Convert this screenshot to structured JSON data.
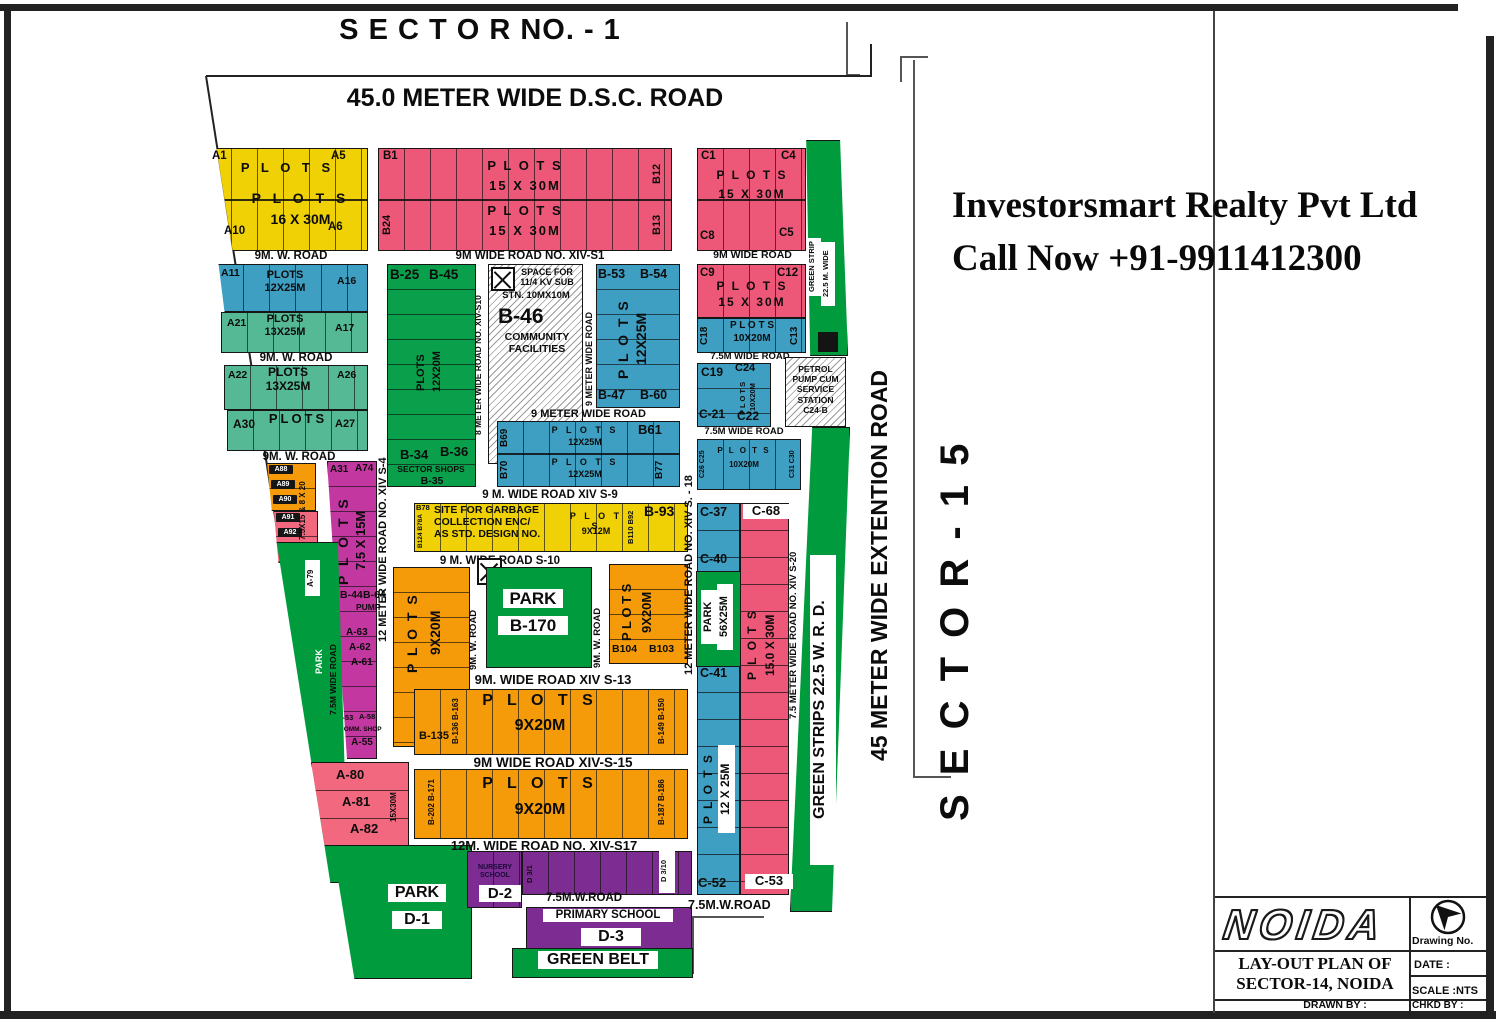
{
  "colors": {
    "yellow": "#EFD106",
    "pink": "#EE5878",
    "pink_light": "#F2697F",
    "blue": "#3E9FC2",
    "teal": "#55B996",
    "green": "#009B3C",
    "green_dark": "#0AA04B",
    "orange": "#F59B0A",
    "magenta": "#C337A0",
    "purple": "#7D2D91",
    "black": "#141414",
    "white": "#FFFFFF"
  },
  "header": {
    "sector_no": "S E C T O R NO. - 1",
    "dsc_road": "45.0 METER WIDE D.S.C. ROAD"
  },
  "promo": {
    "line1": "Investorsmart Realty Pvt Ltd",
    "line2": "Call Now +91-9911412300"
  },
  "margin": {
    "extension_road": "45 METER WIDE EXTENTION ROAD",
    "sector_15": "S E C T O R - 1 5"
  },
  "a": {
    "a1": "A1",
    "a5": "A5",
    "plots_top": "P L O T S",
    "plots16_1": "P L O T S",
    "plots16_2": "16 X 30M",
    "a10": "A10",
    "a6": "A6",
    "road_9mw1": "9M. W. ROAD",
    "a11": "A11",
    "plots12x25": "PLOTS\n12X25M",
    "a16": "A16",
    "a21": "A21",
    "plots13x25": "PLOTS\n13X25M",
    "a17": "A17",
    "road_9mw2": "9M. W. ROAD",
    "a22": "A22",
    "plots13x25b": "PLOTS\n13X25M",
    "a26": "A26",
    "a30": "A30",
    "plots_sm": "PLOTS",
    "a27": "A27",
    "road_9mw3": "9M. W. ROAD",
    "a88": "A88",
    "a89": "A89",
    "a90": "A90",
    "a91": "A91",
    "a92": "A92",
    "a93": "A93",
    "size_mix": "7.5X15 & 8 X 20",
    "a31": "A31",
    "a74": "A74",
    "plots_v": "P L O T S",
    "size75x15": "7.5 X 15M",
    "b44": "B-44",
    "b64": "B-64",
    "pump": "PUMP",
    "a63": "A-63",
    "a62": "A-62",
    "a61": "A-61",
    "a53": "A-53",
    "a58": "A-58",
    "comm_shop": "COMM. SHOP",
    "a55": "A-55",
    "a79": "A-79",
    "park": "PARK",
    "road75v": "7.5M WIDE ROAD",
    "a80": "A-80",
    "a81": "A-81",
    "a82": "A-82",
    "size15x30": "15X30M"
  },
  "b": {
    "b1": "B1",
    "b12": "B12",
    "plots15_1": "P L O T S\n15 X 30M",
    "b24": "B24",
    "b13": "B13",
    "plots15_2": "P L O T S\n15 X 30M",
    "road_s1": "9M WIDE ROAD NO. XIV-S1",
    "b25": "B-25",
    "b45": "B-45",
    "plots_v": "PLOTS",
    "size12x20": "12X20M",
    "b34": "B-34",
    "b36": "B-36",
    "sector_shops": "SECTOR SHOPS",
    "b35": "B-35",
    "road_s10v": "8 METER WIDE ROAD NO. XIV-S10",
    "kv1": "SPACE FOR\n11/4 KV SUB",
    "kv2": "STN. 10MX10M",
    "b46": "B-46",
    "community": "COMMUNITY\nFACILITIES",
    "road_9mv": "9 METER WIDE ROAD",
    "b53": "B-53",
    "b54": "B-54",
    "plots_v2": "P L O T S",
    "size12x25": "12X25M",
    "b47": "B-47",
    "b60": "B-60",
    "road_9mh": "9 METER WIDE ROAD",
    "b69": "B69",
    "plots_r1": "P L O T S",
    "size_r1": "12X25M",
    "b61": "B61",
    "b70": "B70",
    "plots_r2": "P L O T S",
    "size_r2": "12X25M",
    "b77": "B77",
    "road_s9": "9 M. WIDE ROAD XIV S-9",
    "b78": "B78",
    "b124": "B124 B78A",
    "garbage": "SITE FOR GARBAGE\nCOLLECTION ENC/\nAS STD. DESIGN NO.",
    "plots9x12": "P L O T S",
    "size9x12": "9X12M",
    "b110": "B110 B92",
    "b93": "B-93",
    "road_s10h": "9 M. WIDE ROAD S-10",
    "plots_lv": "P L O T S",
    "size_lv": "9X20M",
    "road_9wv1": "9M. W. ROAD",
    "park": "PARK",
    "b170": "B-170",
    "road_9wv2": "9M. W. ROAD",
    "plots_rv": "P L O T S",
    "size_rv": "9X20M",
    "b104": "B104",
    "b103": "B103",
    "road_s13": "9M. WIDE ROAD XIV S-13",
    "plots1": "P L O T S",
    "size1": "9X20M",
    "b135": "B-135",
    "b136": "B-136 B-163",
    "b149": "B-149 B-150",
    "road_s15": "9M WIDE ROAD XIV-S-15",
    "plots2": "P L O T S",
    "size2": "9X20M",
    "b202": "B-202 B-171",
    "b187": "B-187 B-186",
    "road_s17": "12M. WIDE ROAD NO. XIV-S17",
    "road_s4": "12 METER WIDE ROAD NO. XIV S-4",
    "road_s18": "12 METER WIDE ROAD NO. XIV S. - 18"
  },
  "c": {
    "c1": "C1",
    "c4": "C4",
    "plots15a": "P L O T S\n15 X 30M",
    "c8": "C8",
    "c5": "C5",
    "road9m": "9M WIDE ROAD",
    "c9": "C9",
    "c12": "C12",
    "plots15b": "P L O T S\n15 X 30M",
    "c18": "C18",
    "plots10a": "P L O T S\n10X20M",
    "c13": "C13",
    "road75a": "7.5M WIDE ROAD",
    "c19": "C19",
    "c24": "C24",
    "plots10v": "P L O T S",
    "size10v": "10X20M",
    "c21": "C-21",
    "c22": "C22",
    "petrol": "PETROL\nPUMP CUM\nSERVICE\nSTATION\nC24-B",
    "road75b": "7.5M WIDE ROAD",
    "c26": "C26 C25",
    "plots10b": "P L O T S",
    "size10b": "10X20M",
    "c31": "C31 C30",
    "strip": "STRIP",
    "gs1": "GREEN STRIP",
    "gs2": "22.5 M. WIDE",
    "c37": "C-37",
    "c40": "C-40",
    "cpark": "PARK",
    "cpark_size": "56X25M",
    "c41": "C-41",
    "plots12v": "P L O T S",
    "size12v": "12 X 25M",
    "c52": "C-52",
    "c68": "C-68",
    "plots15v": "P L O T S",
    "size15v": "15.0 X 30M",
    "c53": "C-53",
    "road_s20": "7.5 METER WIDE ROAD NO. XIV S-20",
    "green_wrd": "GREEN STRIPS 22.5 W. R. D.",
    "road75w": "7.5M.W.ROAD"
  },
  "d": {
    "nursery": "NURSERY\nSCHOOL",
    "d2": "D-2",
    "d31": "D 3/1",
    "d310": "D 3/10",
    "road75w": "7.5M.W.ROAD",
    "primary": "PRIMARY SCHOOL",
    "d3": "D-3",
    "green_belt": "GREEN BELT",
    "park": "PARK",
    "d1": "D-1"
  },
  "tb": {
    "logo": "NOIDA",
    "drawing_no": "Drawing No.",
    "title1": "LAY-OUT PLAN OF",
    "title2": "SECTOR-14, NOIDA",
    "date": "DATE :",
    "scale": "SCALE :NTS",
    "drawn": "DRAWN BY :",
    "chkd": "CHKD BY :"
  }
}
